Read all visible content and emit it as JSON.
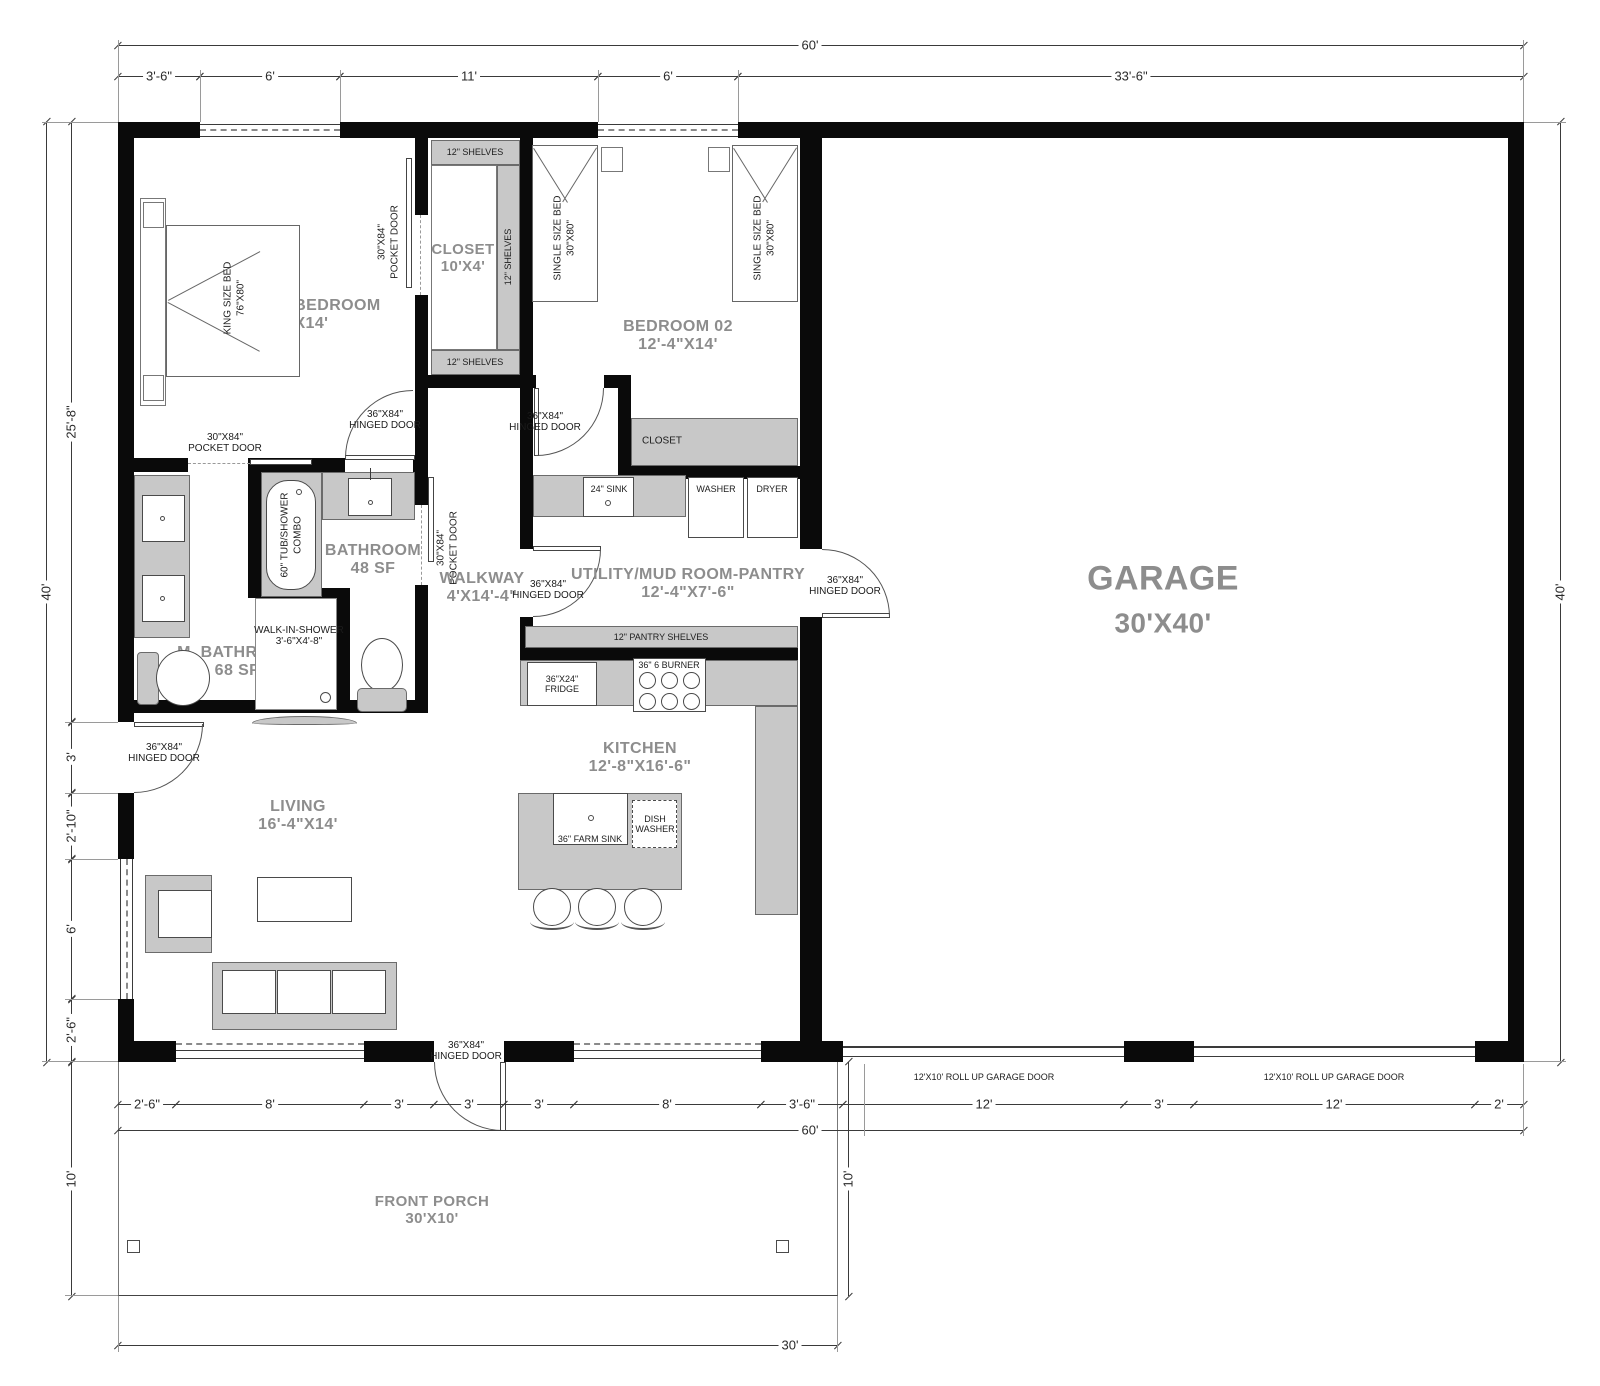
{
  "dims": {
    "top_total": "60'",
    "top_segs": [
      "3'-6\"",
      "6'",
      "11'",
      "6'",
      "33'-6\""
    ],
    "left_total": "40'",
    "left_segs": [
      "25'-8\"",
      "3'",
      "2'-10\"",
      "6'",
      "2'-6\""
    ],
    "right_total": "40'",
    "bottom_segs": [
      "2'-6\"",
      "8'",
      "3'",
      "3'",
      "3'",
      "8'",
      "3'-6\"",
      "12'",
      "3'",
      "12'",
      "2'"
    ],
    "bottom_total": "60'",
    "porch_width": "30'",
    "porch_depth": "10'"
  },
  "rooms": {
    "master": {
      "name": "MASTER BEDROOM",
      "size": "12'X14'"
    },
    "closet": {
      "name": "CLOSET",
      "size": "10'X4'"
    },
    "bedroom02": {
      "name": "BEDROOM 02",
      "size": "12'-4\"X14'"
    },
    "bathroom": {
      "name": "BATHROOM",
      "size": "48 SF"
    },
    "m_bathroom": {
      "name": "M. BATHROOM",
      "size": "68 SF"
    },
    "walkway": {
      "name": "WALKWAY",
      "size": "4'X14'-4\""
    },
    "utility": {
      "name": "UTILITY/MUD ROOM-PANTRY",
      "size": "12'-4\"X7'-6\""
    },
    "kitchen": {
      "name": "KITCHEN",
      "size": "12'-8\"X16'-6\""
    },
    "living": {
      "name": "LIVING",
      "size": "16'-4\"X14'"
    },
    "garage": {
      "name": "GARAGE",
      "size": "30'X40'"
    },
    "porch": {
      "name": "FRONT PORCH",
      "size": "30'X10'"
    }
  },
  "labels": {
    "shelves": "12\" SHELVES",
    "pantry_shelves": "12\" PANTRY SHELVES",
    "king_bed_l1": "KING SIZE BED",
    "king_bed_l2": "76\"X80\"",
    "single_bed_l1": "SINGLE SIZE BED",
    "single_bed_l2": "30\"X80\"",
    "pocket_door_l1": "30\"X84\"",
    "pocket_door_l2": "POCKET DOOR",
    "hinged_door_l1": "36\"X84\"",
    "hinged_door_l2": "HINGED DOOR",
    "tub_l1": "60\" TUB/SHOWER",
    "tub_l2": "COMBO",
    "shower_l1": "WALK-IN-SHOWER",
    "shower_l2": "3'-6\"X4'-8\"",
    "closet_small": "CLOSET",
    "sink24": "24\" SINK",
    "washer": "WASHER",
    "dryer": "DRYER",
    "fridge_l1": "36\"X24\"",
    "fridge_l2": "FRIDGE",
    "burner": "36\" 6 BURNER",
    "farm_sink": "36\" FARM SINK",
    "dw_l1": "DISH",
    "dw_l2": "WASHER",
    "rollup": "12'X10' ROLL UP GARAGE DOOR"
  }
}
